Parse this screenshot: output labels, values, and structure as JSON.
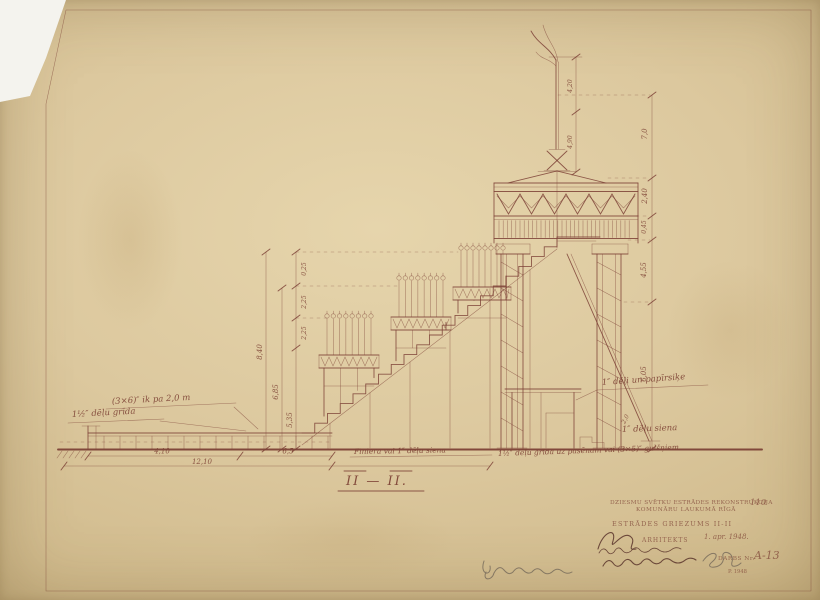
{
  "paper": {
    "tone": "#dcc89e",
    "ink": "#7c4136"
  },
  "section_label": {
    "text": "II — II."
  },
  "annotations": {
    "joists_note": "(3×6)″ ik pa 2,0 m",
    "floor_note_left": "1½″ dēļu grīda",
    "wall_note_center": "Finiera vai 1″ dēļu siena",
    "floor_note_right": "1½″ dēļu grīda uz pasēnam vai (3×5)″ gulšņiem",
    "roof_note": "1″ dēļi un papīrsiķe",
    "wall_note_right": "1″ dēļu siena"
  },
  "dimensions": {
    "bottom": [
      "4,10",
      "6,5",
      "12,10"
    ],
    "left_small": [
      "0,25",
      "2,25",
      "2,25"
    ],
    "left_totals": [
      "8,40",
      "6,85",
      "5,35"
    ],
    "right": [
      "7,0",
      "2,40",
      "0,45",
      "4,55",
      "6,05",
      "2,0"
    ],
    "flag": [
      "4,20",
      "4,90"
    ]
  },
  "title_block": {
    "project_line1": "DZIESMU SVĒTKU ESTRĀDES REKONSTRUKCIJA",
    "project_line2": "KOMUNĀRU LAUKUMĀ RĪGĀ",
    "sheet_no": "110",
    "drawing_title": "ESTRĀDES GRIEZUMS II-II",
    "role_label": "ARHITEKTS",
    "date": "1. apr. 1948.",
    "drawing_no_label": "DARBS Nr.",
    "drawing_no": "A-13",
    "stamp_small": "P. 1948"
  }
}
